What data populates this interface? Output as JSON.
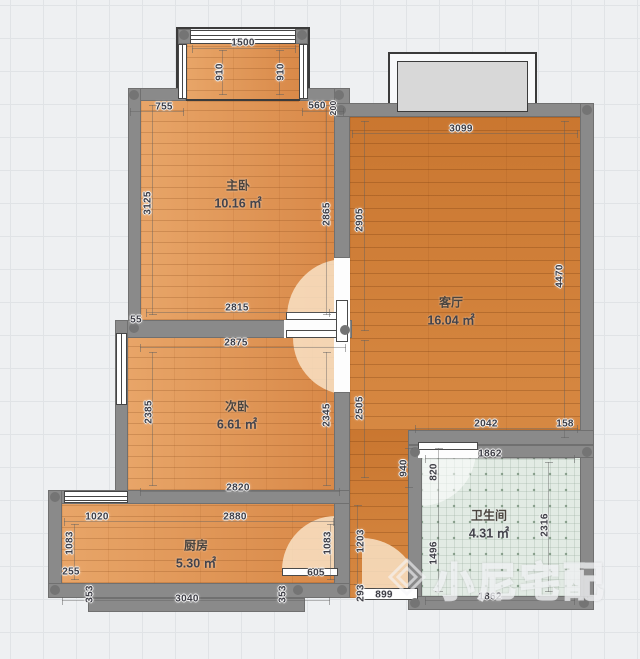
{
  "watermark": {
    "text": "小尼宅配"
  },
  "rooms": {
    "master": {
      "name": "主卧",
      "area": "10.16 ㎡"
    },
    "second": {
      "name": "次卧",
      "area": "6.61 ㎡"
    },
    "living": {
      "name": "客厅",
      "area": "16.04 ㎡"
    },
    "kitchen": {
      "name": "厨房",
      "area": "5.30 ㎡"
    },
    "bath": {
      "name": "卫生间",
      "area": "4.31 ㎡"
    }
  },
  "dims": {
    "bay_width": "1500",
    "bay_left": "910",
    "bay_right": "910",
    "master_top_left": "755",
    "master_top_right": "560",
    "master_top_corner": "200",
    "master_left": "3125",
    "master_right": "2865",
    "master_bottom": "2815",
    "left_step": "55",
    "second_top": "2875",
    "second_left": "2385",
    "second_right": "2345",
    "second_bottom": "2820",
    "living_top": "3099",
    "living_left_upper": "2905",
    "living_left_lower": "2505",
    "living_right": "4470",
    "living_bottom": "2042",
    "living_bottom_right": "158",
    "hall_height": "940",
    "hall_left_upper": "1203",
    "hall_left_lower": "293",
    "entry_door": "899",
    "kitchen_window": "1020",
    "kitchen_top": "2880",
    "kitchen_left": "1083",
    "kitchen_left_step": "255",
    "kitchen_bottom_left": "353",
    "kitchen_bottom": "3040",
    "kitchen_bottom_right": "353",
    "kitchen_door": "605",
    "kitchen_right": "1083",
    "bath_top": "1862",
    "bath_door": "820",
    "bath_left": "1496",
    "bath_right": "2316",
    "bath_bottom": "1862"
  },
  "colors": {
    "wood_bedroom": "#de9050",
    "wood_living": "#cf7c34",
    "tile_bath": "#e2ebe4",
    "wall": "#8a8a8a",
    "door_arc": "#fae5ca",
    "balcony_fill": "#d8d8d8"
  }
}
